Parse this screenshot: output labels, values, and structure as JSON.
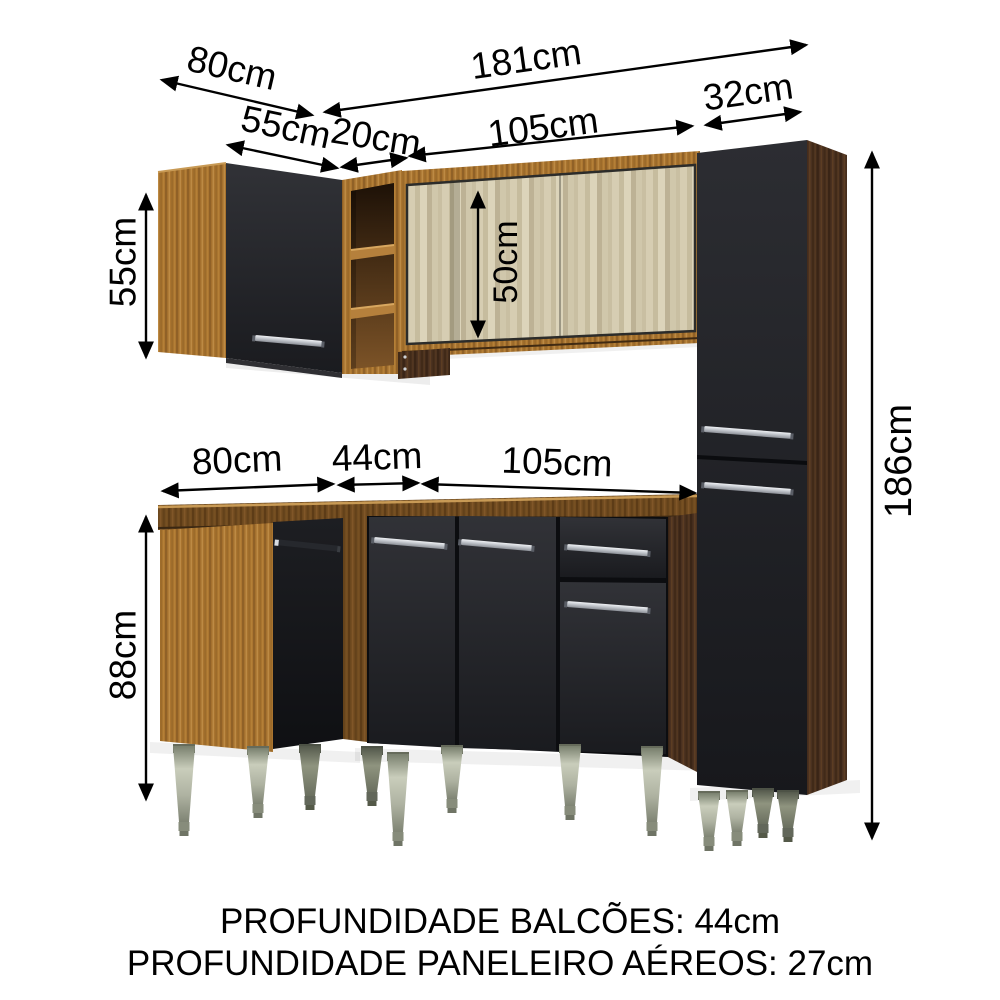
{
  "dimensions": {
    "upper_depth": "80cm",
    "upper_total_width": "181cm",
    "upper_left_cabinet_width": "55cm",
    "niche_width": "20cm",
    "upper_glass_cabinet_width": "105cm",
    "tall_cabinet_width": "32cm",
    "upper_left_cabinet_height": "55cm",
    "glass_opening_height": "50cm",
    "tall_cabinet_height": "186cm",
    "base_left_width": "80cm",
    "base_corner_width": "44cm",
    "base_main_width": "105cm",
    "base_cabinet_height": "88cm"
  },
  "footer": {
    "line1": "PROFUNDIDADE BALCÕES: 44cm",
    "line2": "PROFUNDIDADE PANELEIRO AÉREOS: 27cm"
  },
  "palette": {
    "background": "#ffffff",
    "annotation": "#000000",
    "wood_light": "#a9742f",
    "wood_dark": "#4a3120",
    "wood_medium": "#6f4a1f",
    "front_black": "#1d1e22",
    "glass_beige": "#cdc3a6",
    "handle_silver": "#c3c7cd",
    "leg_gray": "#aeb2a1"
  }
}
